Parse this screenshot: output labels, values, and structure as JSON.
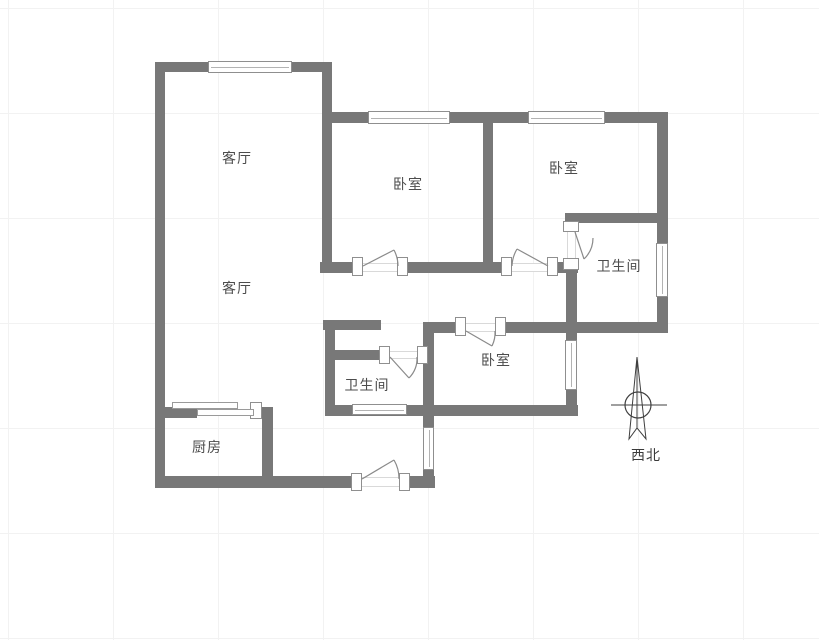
{
  "rooms": {
    "living_upper": {
      "label": "客厅"
    },
    "living_lower": {
      "label": "客厅"
    },
    "bedroom_left": {
      "label": "卧室"
    },
    "bedroom_right": {
      "label": "卧室"
    },
    "bedroom_middle": {
      "label": "卧室"
    },
    "bathroom_upper": {
      "label": "卫生间"
    },
    "bathroom_lower": {
      "label": "卫生间"
    },
    "kitchen": {
      "label": "厨房"
    }
  },
  "compass": {
    "direction_label": "西北"
  },
  "colors": {
    "wall": "#787878",
    "frame_border": "#8f8f8f",
    "text": "#4c4c4c"
  }
}
